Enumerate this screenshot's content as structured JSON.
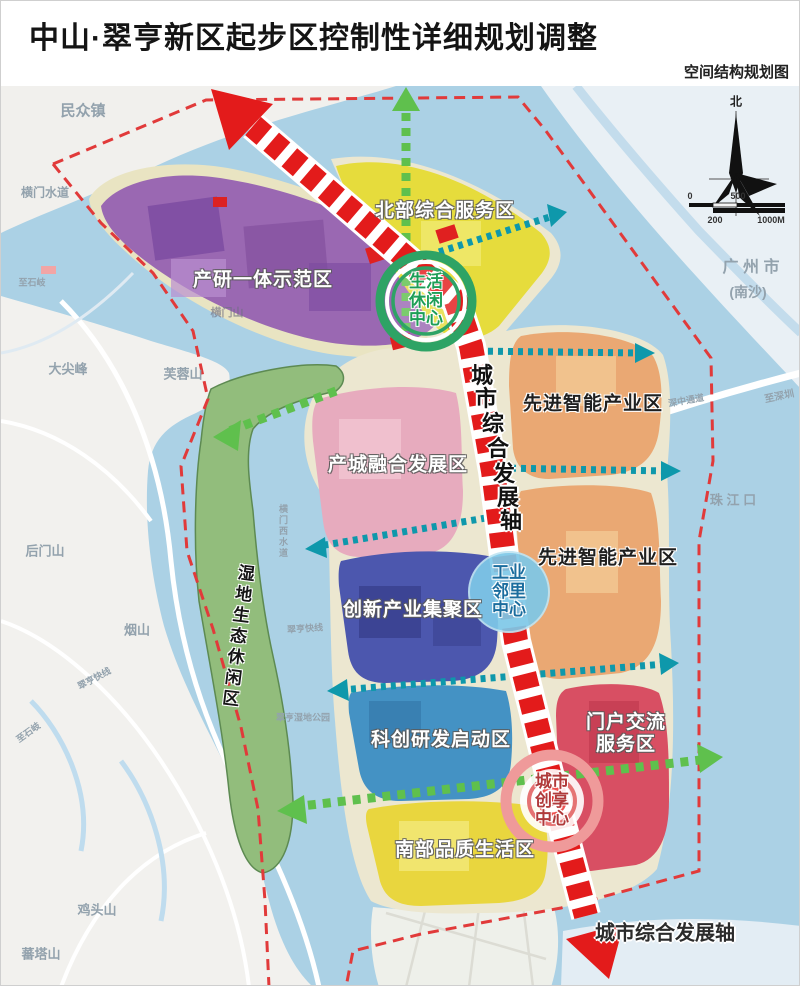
{
  "header": {
    "title": "中山·翠亨新区起步区控制性详细规划调整",
    "subtitle": "空间结构规划图"
  },
  "zones": [
    {
      "name": "产研一体示范区",
      "color": "#9a68b2"
    },
    {
      "name": "北部综合服务区",
      "color": "#e6dc3c"
    },
    {
      "name": "先进智能产业区",
      "color": "#eaa873"
    },
    {
      "name": "先进智能产业区",
      "color": "#eaa873"
    },
    {
      "name": "产城融合发展区",
      "color": "#e7abbe"
    },
    {
      "name": "创新产业集聚区",
      "color": "#4c57ae"
    },
    {
      "name": "科创研发启动区",
      "color": "#4492c4"
    },
    {
      "name": "门户交流服务区",
      "color": "#d84f63"
    },
    {
      "name": "南部品质生活区",
      "color": "#e9d63e"
    },
    {
      "name": "湿地生态休闲区",
      "color": "#92bd7c"
    }
  ],
  "centers": [
    {
      "name": "生活休闲中心",
      "ring_color": "#2ea365"
    },
    {
      "name": "工业邻里中心",
      "ring_color": "#7ec8e8"
    },
    {
      "name": "城市创享中心",
      "ring_color": "#ef9a9a"
    }
  ],
  "axis": {
    "chars": [
      "城",
      "市",
      "综",
      "合",
      "发",
      "展",
      "轴"
    ],
    "bottom_label": "城市综合发展轴",
    "color": "#e31b1b"
  },
  "geo": {
    "minzhongzhen": "民众镇",
    "hengmen_waterway": "横门水道",
    "zhishiqi": "至石岐",
    "zhishiqi2": "至石岐",
    "dajianfeng": "大尖峰",
    "furongshan": "芙蓉山",
    "hengmenshan": "横门山",
    "houmenshan": "后门山",
    "yanshan": "烟山",
    "jitoushan": "鸡头山",
    "fantashan": "蕃塔山",
    "guangzhou": "广 州 市",
    "nansha": "(南沙)",
    "zhujiangkou": "珠 江 口",
    "shenzhong_corridor": "深中通道",
    "zhishenzhen": "至深圳",
    "cuiheng_express1": "翠亨快线",
    "cuiheng_express2": "翠亨快线",
    "hengmen_west_waterway": "横门西水道",
    "wetland_park": "翠亨湿地公园"
  },
  "compass": {
    "north": "北"
  },
  "scalebar": {
    "zero": "0",
    "l500": "500",
    "l200": "200",
    "l1000": "1000M"
  }
}
